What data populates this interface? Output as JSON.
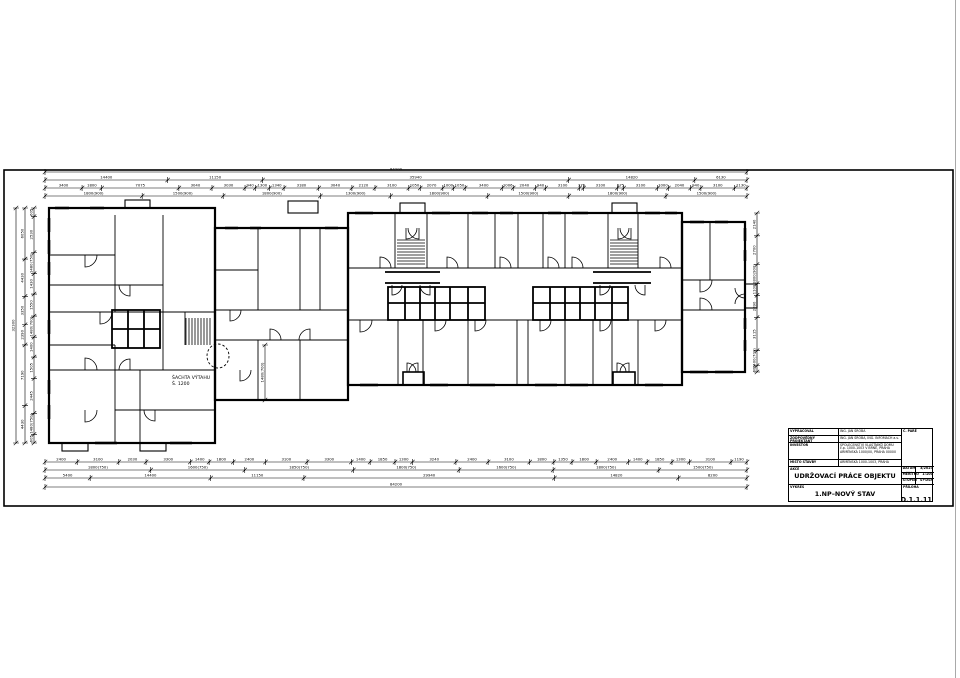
{
  "drawing": {
    "shaft_line1": "ŠACHTA VÝTAHU",
    "shaft_line2": "Š. 1200",
    "dims": {
      "top_total": [
        "84200"
      ],
      "top_sections": [
        "14400",
        "11150",
        "35940",
        "14820",
        "6130"
      ],
      "top_detail": [
        "3400",
        "1800",
        "7075",
        "3040",
        "3030",
        "940",
        "1300",
        "1340",
        "3180",
        "3040",
        "2120",
        "3100",
        "1050",
        "2070",
        "1000",
        "1050",
        "3400",
        "1006",
        "2040",
        "940",
        "3100",
        "375",
        "3100",
        "575",
        "3100",
        "1000",
        "2040",
        "940",
        "3100",
        "1130"
      ],
      "top_windows": [
        "1800(900)",
        "1500(900)",
        "1800(900)",
        "1300(900)",
        "1800(900)",
        "1500(900)",
        "1800(900)",
        "1500(900)"
      ],
      "bottom_detail": [
        "2400",
        "3100",
        "2030",
        "3300",
        "1400",
        "1800",
        "2400",
        "3100",
        "3300",
        "1400",
        "1850",
        "1300",
        "3240",
        "2400",
        "3100",
        "1800",
        "1350",
        "1800",
        "2400",
        "1400",
        "1850",
        "1300",
        "3100",
        "1190"
      ],
      "bottom_windows": [
        "1800(750)",
        "1600(750)",
        "1850(750)",
        "1800(750)",
        "1600(750)",
        "1800(750)",
        "1500(750)"
      ],
      "bottom_sections": [
        "5400",
        "14400",
        "11150",
        "29940",
        "14820",
        "8200"
      ],
      "bottom_total": [
        "84200"
      ],
      "left_total": [
        "32300"
      ],
      "left_sections": [
        "6050",
        "4430",
        "3350",
        "2390",
        "7190",
        "4430"
      ],
      "left_detail": [
        "605",
        "2530",
        "1480(750)",
        "1430",
        "1550",
        "1480(700)",
        "1400",
        "1505",
        "2445",
        "1480(750)",
        "605"
      ],
      "right_detail": [
        "2140",
        "2700",
        "1800(900)",
        "1100",
        "2090",
        "3115",
        "1400(700)",
        "600"
      ],
      "connector_detail": [
        "1480(700)"
      ]
    }
  },
  "title_block": {
    "vypracoval_label": "VYPRACOVAL",
    "vypracoval_value": "ING. JAN SROBA",
    "zodp_label": "ZODPOVĚDNÝ PROJEKTANT",
    "zodp_value": "ING. JAN SROBA, ING. INFOMACH a.s.",
    "investor_label": "INVESTOR",
    "investor_line1": "SPOLEČENSTVÍ VLASTNÍKŮ DOMU",
    "investor_line2": "č.p. 1000-1003 V BRNĚ, PRAHA",
    "investor_line3": "ARMÉNSKÁ 1000/00, PRAHA 00000",
    "misto_label": "MÍSTO STAVBY",
    "misto_value": "ARMÉNSKÁ 1000-1003, PRAHA",
    "pare_label": "Č. PARÉ",
    "akce_label": "AKCE",
    "akce_value": "UDRŽOVACÍ PRÁCE OBJEKTU",
    "datum_label": "DATUM",
    "datum_value": "3/2023",
    "meritko_label": "MĚŘÍTKO",
    "meritko_value": "1:100",
    "stupen_label": "STUPEŇ",
    "stupen_value": "S+DSP",
    "vykres_label": "VÝKRES",
    "vykres_value": "1.NP–NOVÝ STAV",
    "priloha_label": "PŘÍLOHA",
    "priloha_value": "D.1.1.11"
  }
}
